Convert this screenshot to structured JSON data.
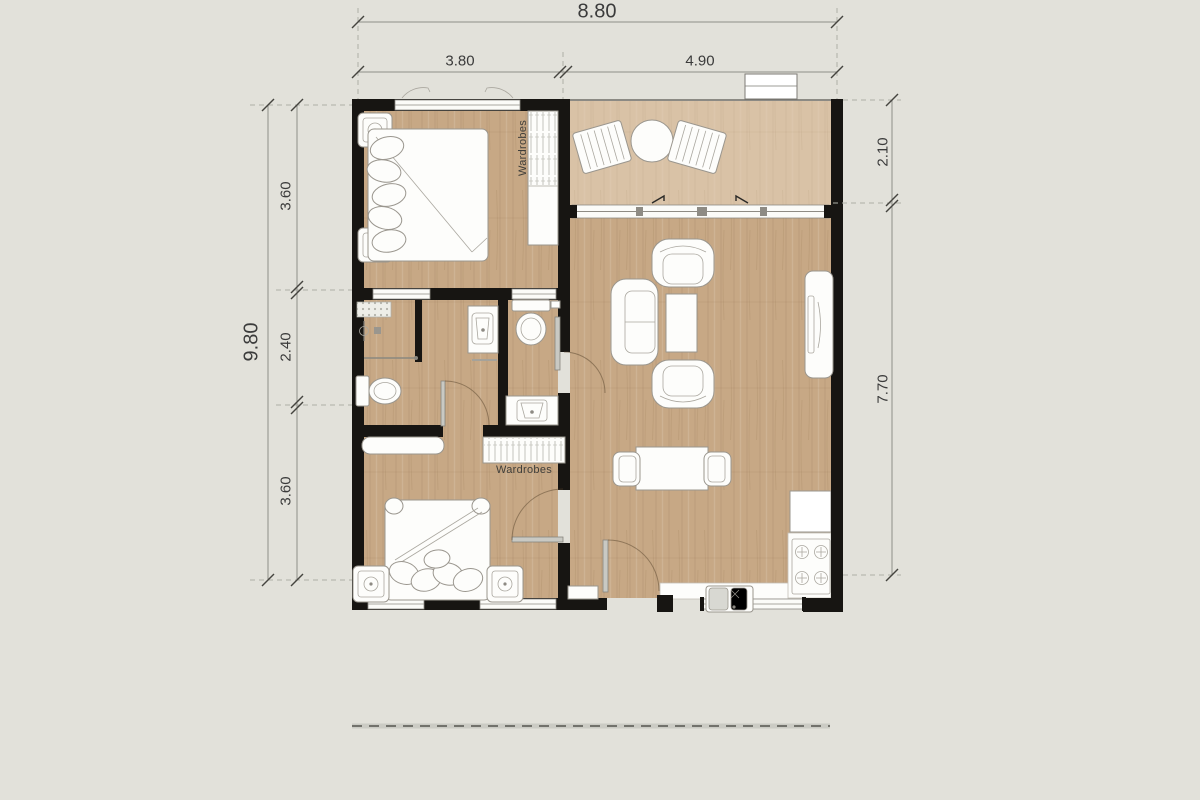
{
  "drawing": {
    "type": "apartment floor plan, top view"
  },
  "colors": {
    "background": "#e2e1da",
    "wall": "#171512",
    "floor_wood": "#c7a885",
    "floor_balcony": "#d9c2a6",
    "dim_text": "#3b3b3b",
    "line": "#8e8e88"
  },
  "dimensions": {
    "top": {
      "overall": "8.80",
      "segments": [
        "3.80",
        "4.90"
      ]
    },
    "left": {
      "overall": "9.80",
      "segments": [
        "3.60",
        "2.40",
        "3.60"
      ]
    },
    "right": {
      "segments": [
        "2.10",
        "7.70"
      ]
    }
  },
  "labels": {
    "wardrobe_bedroom1": "Wardrobes",
    "wardrobe_bedroom2": "Wardrobes"
  }
}
